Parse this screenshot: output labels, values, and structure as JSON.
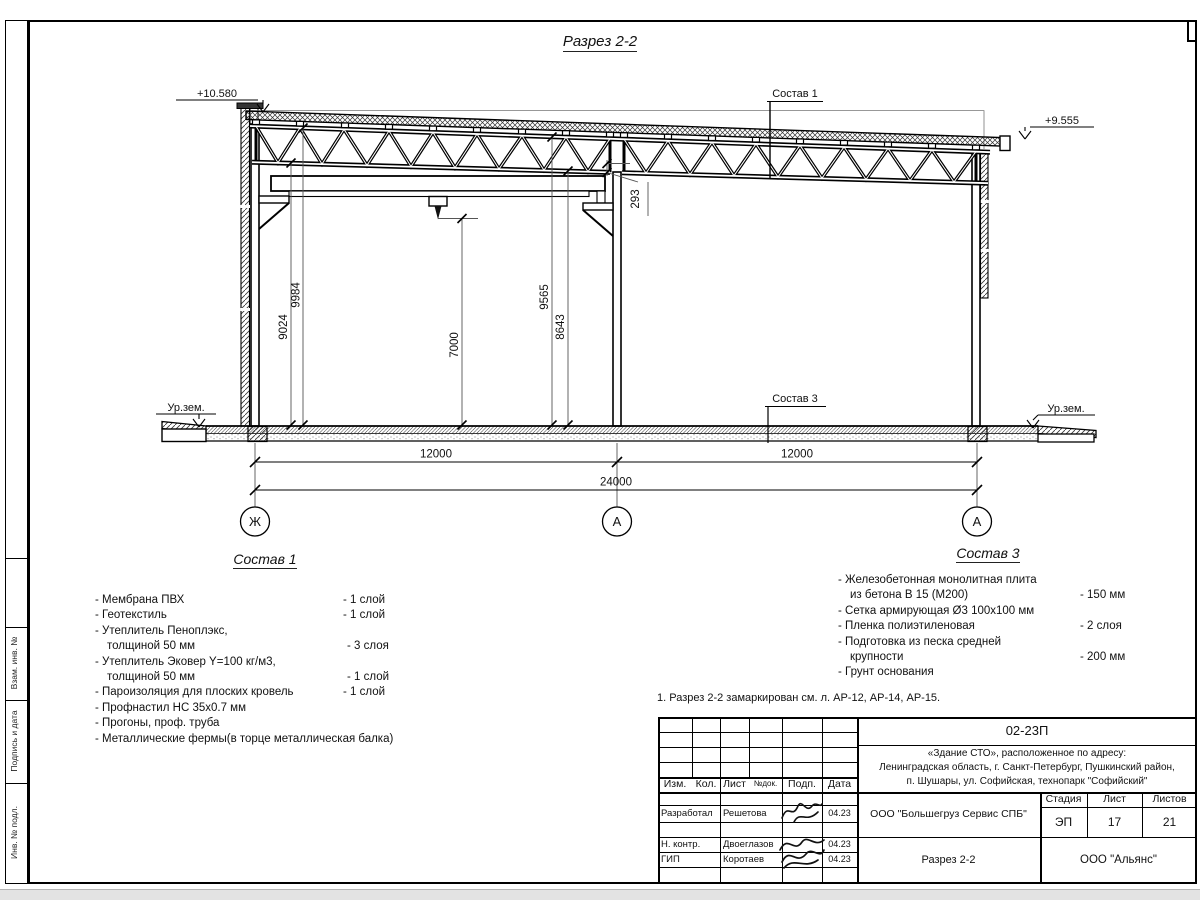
{
  "page": {
    "title": "Разрез 2-2"
  },
  "labels": {
    "elev_left": "+10.580",
    "elev_right": "+9.555",
    "ground": "Ур.зем.",
    "note": "1. Разрез 2-2 замаркирован см. л. АР-12, АР-14, АР-15."
  },
  "dims": {
    "h9024": "9024",
    "h9984": "9984",
    "h7000": "7000",
    "h9565": "9565",
    "h8643": "8643",
    "gap293": "293",
    "span1": "12000",
    "span2": "12000",
    "total": "24000"
  },
  "axes": [
    "Ж",
    "А",
    "А"
  ],
  "sostav1": {
    "title": "Состав 1",
    "rows": [
      {
        "name": "- Мембрана ПВХ",
        "qty": "- 1 слой"
      },
      {
        "name": "- Геотекстиль",
        "qty": "- 1 слой"
      },
      {
        "name": "- Утеплитель Пеноплэкс,",
        "qty": ""
      },
      {
        "name": "толщиной 50 мм",
        "qty": "- 3 слоя"
      },
      {
        "name": "- Утеплитель Эковер Y=100 кг/м3,",
        "qty": ""
      },
      {
        "name": "толщиной 50 мм",
        "qty": "- 1 слой"
      },
      {
        "name": "- Пароизоляция для плоских кровель",
        "qty": "- 1 слой"
      },
      {
        "name": "- Профнастил НС 35х0.7 мм",
        "qty": ""
      },
      {
        "name": "- Прогоны, проф. труба",
        "qty": ""
      },
      {
        "name": "- Металлические фермы(в торце металлическая балка)",
        "qty": ""
      }
    ]
  },
  "sostav3": {
    "title": "Состав 3",
    "rows": [
      {
        "name": "- Железобетонная  монолитная плита",
        "qty": ""
      },
      {
        "name": "из бетона В 15 (М200)",
        "qty": "- 150 мм"
      },
      {
        "name": "- Сетка армирующая Ø3 100х100 мм",
        "qty": ""
      },
      {
        "name": "- Пленка полиэтиленовая",
        "qty": "-  2 слоя"
      },
      {
        "name": "- Подготовка из песка средней",
        "qty": ""
      },
      {
        "name": "крупности",
        "qty": "- 200 мм"
      },
      {
        "name": "- Грунт основания",
        "qty": ""
      }
    ]
  },
  "titleblock": {
    "code": "02-23П",
    "project_line1": "«Здание СТО», расположенное по адресу:",
    "project_line2": "Ленинградская область, г. Санкт-Петербург, Пушкинский район,",
    "project_line3": "п. Шушары, ул. Софийская, технопарк \"Софийский\"",
    "cols": [
      "Изм.",
      "Кол.",
      "Лист",
      "№док.",
      "Подп.",
      "Дата"
    ],
    "rows": [
      {
        "role": "Разработал",
        "name": "Решетова",
        "date": "04.23"
      },
      {
        "role": "Н. контр.",
        "name": "Двоеглазов",
        "date": "04.23"
      },
      {
        "role": "ГИП",
        "name": "Коротаев",
        "date": "04.23"
      }
    ],
    "company": "ООО \"Большегруз Сервис СПБ\"",
    "stage_label": "Стадия",
    "sheet_label": "Лист",
    "sheets_label": "Листов",
    "stage": "ЭП",
    "sheet": "17",
    "sheets": "21",
    "drawing": "Разрез 2-2",
    "org": "ООО \"Альянс\""
  },
  "side_labels": [
    "Взам. инв. №",
    "Подпись и дата",
    "Инв. № подл."
  ]
}
